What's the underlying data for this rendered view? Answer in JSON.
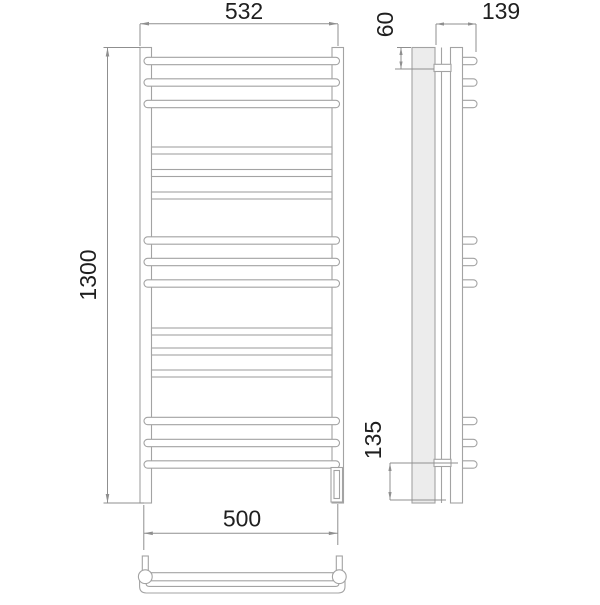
{
  "dimension_labels": {
    "top_width": "532",
    "overall_height": "1300",
    "bottom_width": "500",
    "depth": "139",
    "top_bracket_offset": "60",
    "bottom_bracket_offset": "135"
  },
  "geometry": {
    "front_round_bar_centers": [
      61,
      82.5,
      104,
      240.5,
      262,
      283.5,
      421,
      443,
      464.5
    ],
    "front_flat_bar_centers": [
      150.5,
      173,
      195.5,
      331.5,
      351.5,
      373.5
    ],
    "side_stub_centers": [
      61,
      82.5,
      104,
      240.5,
      262,
      283.5,
      421,
      443,
      464.5
    ]
  },
  "colors": {
    "line": "#a3a3a3",
    "dim_line": "#8f8f8f",
    "text": "#1f1f1f",
    "wall_fill": "#ececec"
  }
}
